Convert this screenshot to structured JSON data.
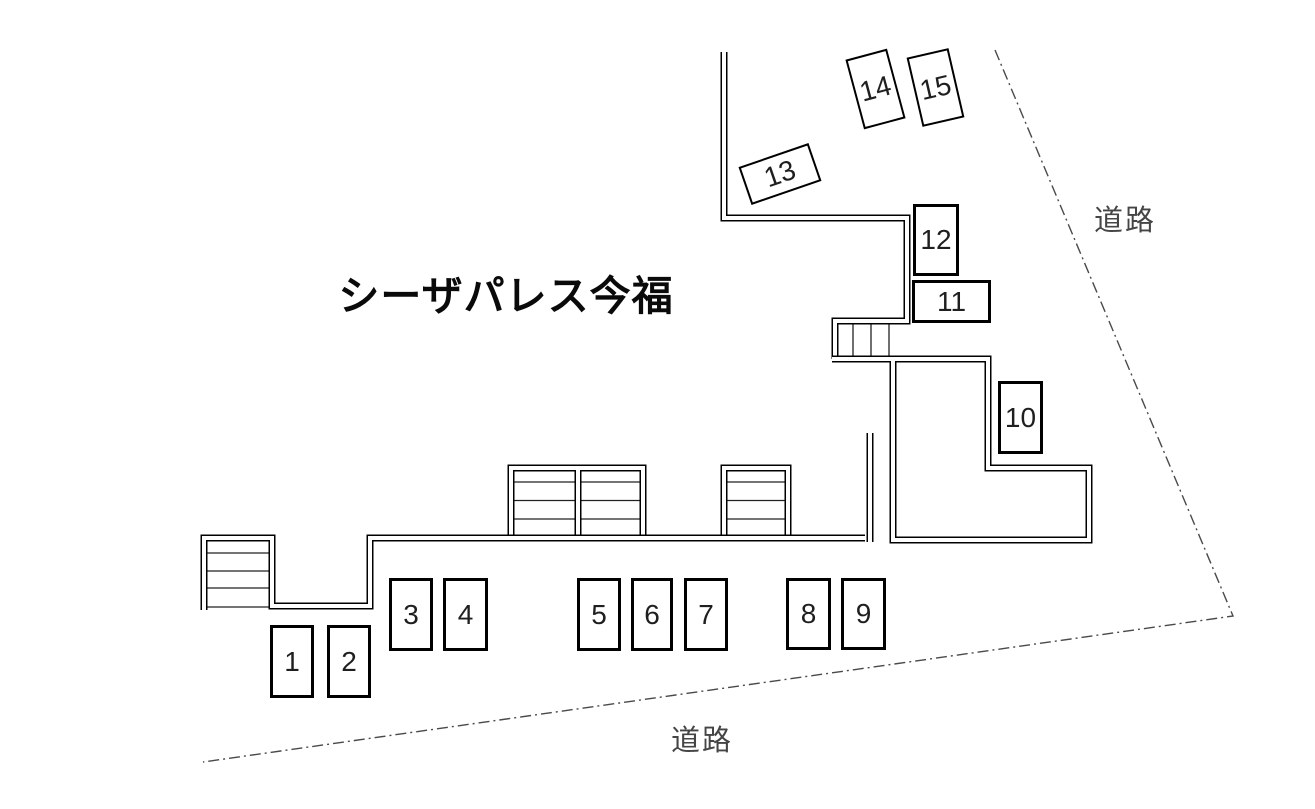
{
  "title": "シーザパレス今福",
  "road_label_top": "道路",
  "road_label_bottom": "道路",
  "spaces": [
    {
      "label": "1"
    },
    {
      "label": "2"
    },
    {
      "label": "3"
    },
    {
      "label": "4"
    },
    {
      "label": "5"
    },
    {
      "label": "6"
    },
    {
      "label": "7"
    },
    {
      "label": "8"
    },
    {
      "label": "9"
    },
    {
      "label": "10"
    },
    {
      "label": "11"
    },
    {
      "label": "12"
    },
    {
      "label": "13"
    },
    {
      "label": "14"
    },
    {
      "label": "15"
    }
  ],
  "colors": {
    "wall": "#000000",
    "space_border": "#000000",
    "space_text": "#1f1f1f",
    "title_text": "#0a0a0a",
    "road_text": "#454545",
    "boundary_line": "#4a4a4a",
    "background": "#ffffff"
  }
}
